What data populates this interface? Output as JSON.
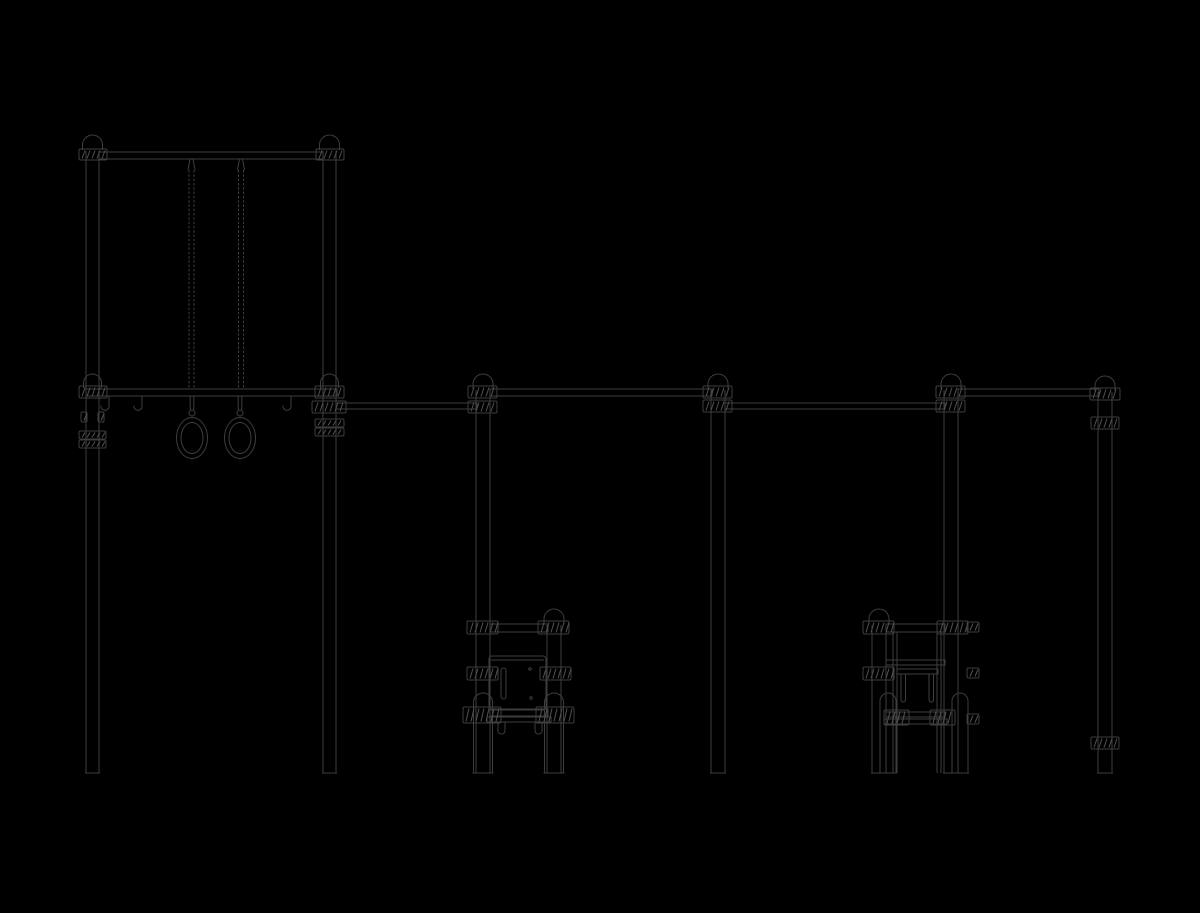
{
  "meta": {
    "subject": "outdoor-calisthenics-rig-elevation-line-drawing",
    "canvas_width": 1200,
    "canvas_height": 913,
    "background": "#000000",
    "line_color": "#3e3e3e",
    "hatch_color": "#525252"
  },
  "drawing": {
    "bars": [
      {
        "name": "pullup-top-bar",
        "x1": 99,
        "x2": 323,
        "y": 152,
        "h": 7
      },
      {
        "name": "rings-bar",
        "x1": 86,
        "x2": 337,
        "y": 389,
        "h": 7
      },
      {
        "name": "rail-1",
        "x1": 336,
        "x2": 477,
        "y": 403,
        "h": 6
      },
      {
        "name": "rail-2",
        "x1": 490,
        "x2": 712,
        "y": 389,
        "h": 7
      },
      {
        "name": "rail-3",
        "x1": 725,
        "x2": 945,
        "y": 403,
        "h": 6
      },
      {
        "name": "rail-4",
        "x1": 958,
        "x2": 1099,
        "y": 389,
        "h": 7
      },
      {
        "name": "bench-a-top-bar",
        "x1": 490,
        "x2": 548,
        "y": 624,
        "h": 8
      },
      {
        "name": "bench-a-bottom-bar",
        "x1": 490,
        "x2": 548,
        "y": 709,
        "h": 7
      },
      {
        "name": "bench-a-lower-plate",
        "x1": 487,
        "x2": 551,
        "y": 717,
        "h": 5
      },
      {
        "name": "bench-b-top-bar",
        "x1": 886,
        "x2": 945,
        "y": 624,
        "h": 8
      },
      {
        "name": "bench-b-rail-1",
        "x1": 886,
        "x2": 945,
        "y": 660,
        "h": 5
      },
      {
        "name": "bench-b-rail-2",
        "x1": 897,
        "x2": 938,
        "y": 669,
        "h": 5
      },
      {
        "name": "bench-b-bottom-bar",
        "x1": 886,
        "x2": 945,
        "y": 712,
        "h": 5
      },
      {
        "name": "bench-b-lower-plate",
        "x1": 884,
        "x2": 947,
        "y": 719,
        "h": 5
      }
    ],
    "posts": [
      {
        "name": "frame-left-post",
        "x": 86,
        "w": 13,
        "y1": 151,
        "y2": 773
      },
      {
        "name": "frame-right-post",
        "x": 323,
        "w": 13,
        "y1": 151,
        "y2": 773
      },
      {
        "name": "rail-post-1",
        "x": 476,
        "w": 14,
        "y1": 390,
        "y2": 773
      },
      {
        "name": "rail-post-2",
        "x": 711,
        "w": 14,
        "y1": 390,
        "y2": 773
      },
      {
        "name": "rail-post-3",
        "x": 944,
        "w": 14,
        "y1": 390,
        "y2": 773
      },
      {
        "name": "rail-post-4",
        "x": 1098,
        "w": 14,
        "y1": 392,
        "y2": 773
      },
      {
        "name": "bench-a-front-post",
        "x": 547,
        "w": 14,
        "y1": 625,
        "y2": 773
      },
      {
        "name": "bench-b-front-post",
        "x": 872,
        "w": 14,
        "y1": 625,
        "y2": 773
      }
    ],
    "domes": [
      {
        "name": "frame-left-cap",
        "cx": 92.5,
        "hw": 10,
        "base": 150,
        "h": 15
      },
      {
        "name": "frame-right-cap",
        "cx": 329.5,
        "hw": 10,
        "base": 150,
        "h": 15
      },
      {
        "name": "frame-left-joint-cap",
        "cx": 92.5,
        "hw": 9,
        "base": 388,
        "h": 14
      },
      {
        "name": "frame-right-joint-cap",
        "cx": 329.5,
        "hw": 9,
        "base": 388,
        "h": 14
      },
      {
        "name": "rail-post-1-cap",
        "cx": 483,
        "hw": 10,
        "base": 389,
        "h": 15
      },
      {
        "name": "rail-post-2-cap",
        "cx": 718,
        "hw": 10,
        "base": 389,
        "h": 15
      },
      {
        "name": "rail-post-3-cap",
        "cx": 951,
        "hw": 10,
        "base": 389,
        "h": 15
      },
      {
        "name": "rail-post-4-cap",
        "cx": 1105,
        "hw": 10,
        "base": 391,
        "h": 15
      },
      {
        "name": "bench-a-post-cap",
        "cx": 554,
        "hw": 10,
        "base": 624,
        "h": 15
      },
      {
        "name": "bench-b-post-cap",
        "cx": 879,
        "hw": 10,
        "base": 624,
        "h": 15
      },
      {
        "name": "bench-a-rear-leg-left",
        "cx": 483,
        "hw": 9.5,
        "base": 708,
        "h": 15,
        "legs": 773
      },
      {
        "name": "bench-a-rear-leg-right",
        "cx": 554,
        "hw": 9.5,
        "base": 708,
        "h": 15,
        "legs": 773
      },
      {
        "name": "bench-b-rear-leg-left",
        "cx": 888,
        "hw": 8,
        "base": 707,
        "h": 14,
        "legs": 773
      },
      {
        "name": "bench-b-rear-leg-right",
        "cx": 960,
        "hw": 8,
        "base": 707,
        "h": 14,
        "legs": 773
      }
    ],
    "legs": [
      {
        "name": "bench-b-inner-leg",
        "x": 893,
        "w": 4,
        "y1": 632,
        "y2": 773
      },
      {
        "name": "bench-b-inner-leg",
        "x": 937,
        "w": 4,
        "y1": 632,
        "y2": 773
      }
    ],
    "clamps": [
      {
        "x": 79,
        "y": 149,
        "w": 28,
        "h": 11
      },
      {
        "x": 316,
        "y": 149,
        "w": 28,
        "h": 11
      },
      {
        "x": 79,
        "y": 386,
        "w": 28,
        "h": 12
      },
      {
        "x": 315,
        "y": 386,
        "w": 29,
        "h": 12
      },
      {
        "x": 312,
        "y": 401,
        "w": 34,
        "h": 12
      },
      {
        "x": 468,
        "y": 401,
        "w": 29,
        "h": 12
      },
      {
        "x": 468,
        "y": 386,
        "w": 29,
        "h": 12
      },
      {
        "x": 703,
        "y": 386,
        "w": 29,
        "h": 12
      },
      {
        "x": 703,
        "y": 400,
        "w": 29,
        "h": 12
      },
      {
        "x": 936,
        "y": 400,
        "w": 29,
        "h": 12
      },
      {
        "x": 936,
        "y": 386,
        "w": 29,
        "h": 12
      },
      {
        "x": 1090,
        "y": 388,
        "w": 30,
        "h": 12
      },
      {
        "x": 315,
        "y": 419,
        "w": 29,
        "h": 8
      },
      {
        "x": 315,
        "y": 428,
        "w": 29,
        "h": 8
      },
      {
        "x": 79,
        "y": 431,
        "w": 27,
        "h": 8
      },
      {
        "x": 79,
        "y": 440,
        "w": 27,
        "h": 8
      },
      {
        "x": 81,
        "y": 412,
        "w": 6,
        "h": 10
      },
      {
        "x": 98,
        "y": 412,
        "w": 6,
        "h": 10
      },
      {
        "x": 1091,
        "y": 417,
        "w": 28,
        "h": 12
      },
      {
        "x": 1091,
        "y": 737,
        "w": 28,
        "h": 12
      },
      {
        "x": 467,
        "y": 621,
        "w": 31,
        "h": 13
      },
      {
        "x": 538,
        "y": 621,
        "w": 31,
        "h": 13
      },
      {
        "x": 467,
        "y": 667,
        "w": 31,
        "h": 13
      },
      {
        "x": 540,
        "y": 667,
        "w": 31,
        "h": 13
      },
      {
        "x": 463,
        "y": 707,
        "w": 38,
        "h": 16
      },
      {
        "x": 536,
        "y": 707,
        "w": 38,
        "h": 16
      },
      {
        "x": 863,
        "y": 621,
        "w": 31,
        "h": 13
      },
      {
        "x": 937,
        "y": 621,
        "w": 31,
        "h": 13
      },
      {
        "x": 863,
        "y": 667,
        "w": 31,
        "h": 13
      },
      {
        "x": 884,
        "y": 710,
        "w": 25,
        "h": 15
      },
      {
        "x": 930,
        "y": 710,
        "w": 25,
        "h": 15
      },
      {
        "x": 967,
        "y": 622,
        "w": 12,
        "h": 10
      },
      {
        "x": 967,
        "y": 668,
        "w": 12,
        "h": 10
      },
      {
        "x": 967,
        "y": 714,
        "w": 12,
        "h": 10
      }
    ],
    "chains": [
      {
        "name": "ring-chain-left",
        "x": 191.5,
        "y1": 159,
        "y2": 389
      },
      {
        "name": "ring-chain-right",
        "x": 241,
        "y1": 159,
        "y2": 389
      }
    ],
    "rings": [
      {
        "name": "gym-ring-left",
        "cx": 192
      },
      {
        "name": "gym-ring-right",
        "cx": 240
      }
    ],
    "ring_geom": {
      "strap_y1": 396,
      "strap_y2": 410,
      "link_cy": 413,
      "link_r": 3,
      "cy": 438,
      "rx": 15.5,
      "ry": 20.5,
      "irx": 11,
      "iry": 15.5
    },
    "hooks": [
      {
        "name": "accessory-hook",
        "x": 107,
        "y": 396
      },
      {
        "name": "accessory-hook",
        "x": 140,
        "y": 396
      },
      {
        "name": "accessory-hook",
        "x": 289,
        "y": 396
      }
    ],
    "panel": {
      "name": "bench-a-board-panel",
      "x": 489,
      "y": 656,
      "w": 57,
      "h": 54,
      "inner_top_y": 660,
      "slot": {
        "x": 501,
        "y": 668,
        "w": 5,
        "h": 31
      },
      "dots": [
        [
          530,
          669
        ],
        [
          531,
          698
        ]
      ]
    },
    "prongs": [
      {
        "name": "bench-b-prong",
        "x": 901,
        "w": 4.5,
        "y1": 674,
        "y2": 702
      },
      {
        "name": "bench-b-prong",
        "x": 929,
        "w": 4.5,
        "y1": 674,
        "y2": 702
      }
    ],
    "bench_hooks": [
      {
        "name": "bench-a-hanger",
        "x": 498,
        "y": 722
      },
      {
        "name": "bench-a-hanger",
        "x": 535,
        "y": 722
      }
    ]
  }
}
